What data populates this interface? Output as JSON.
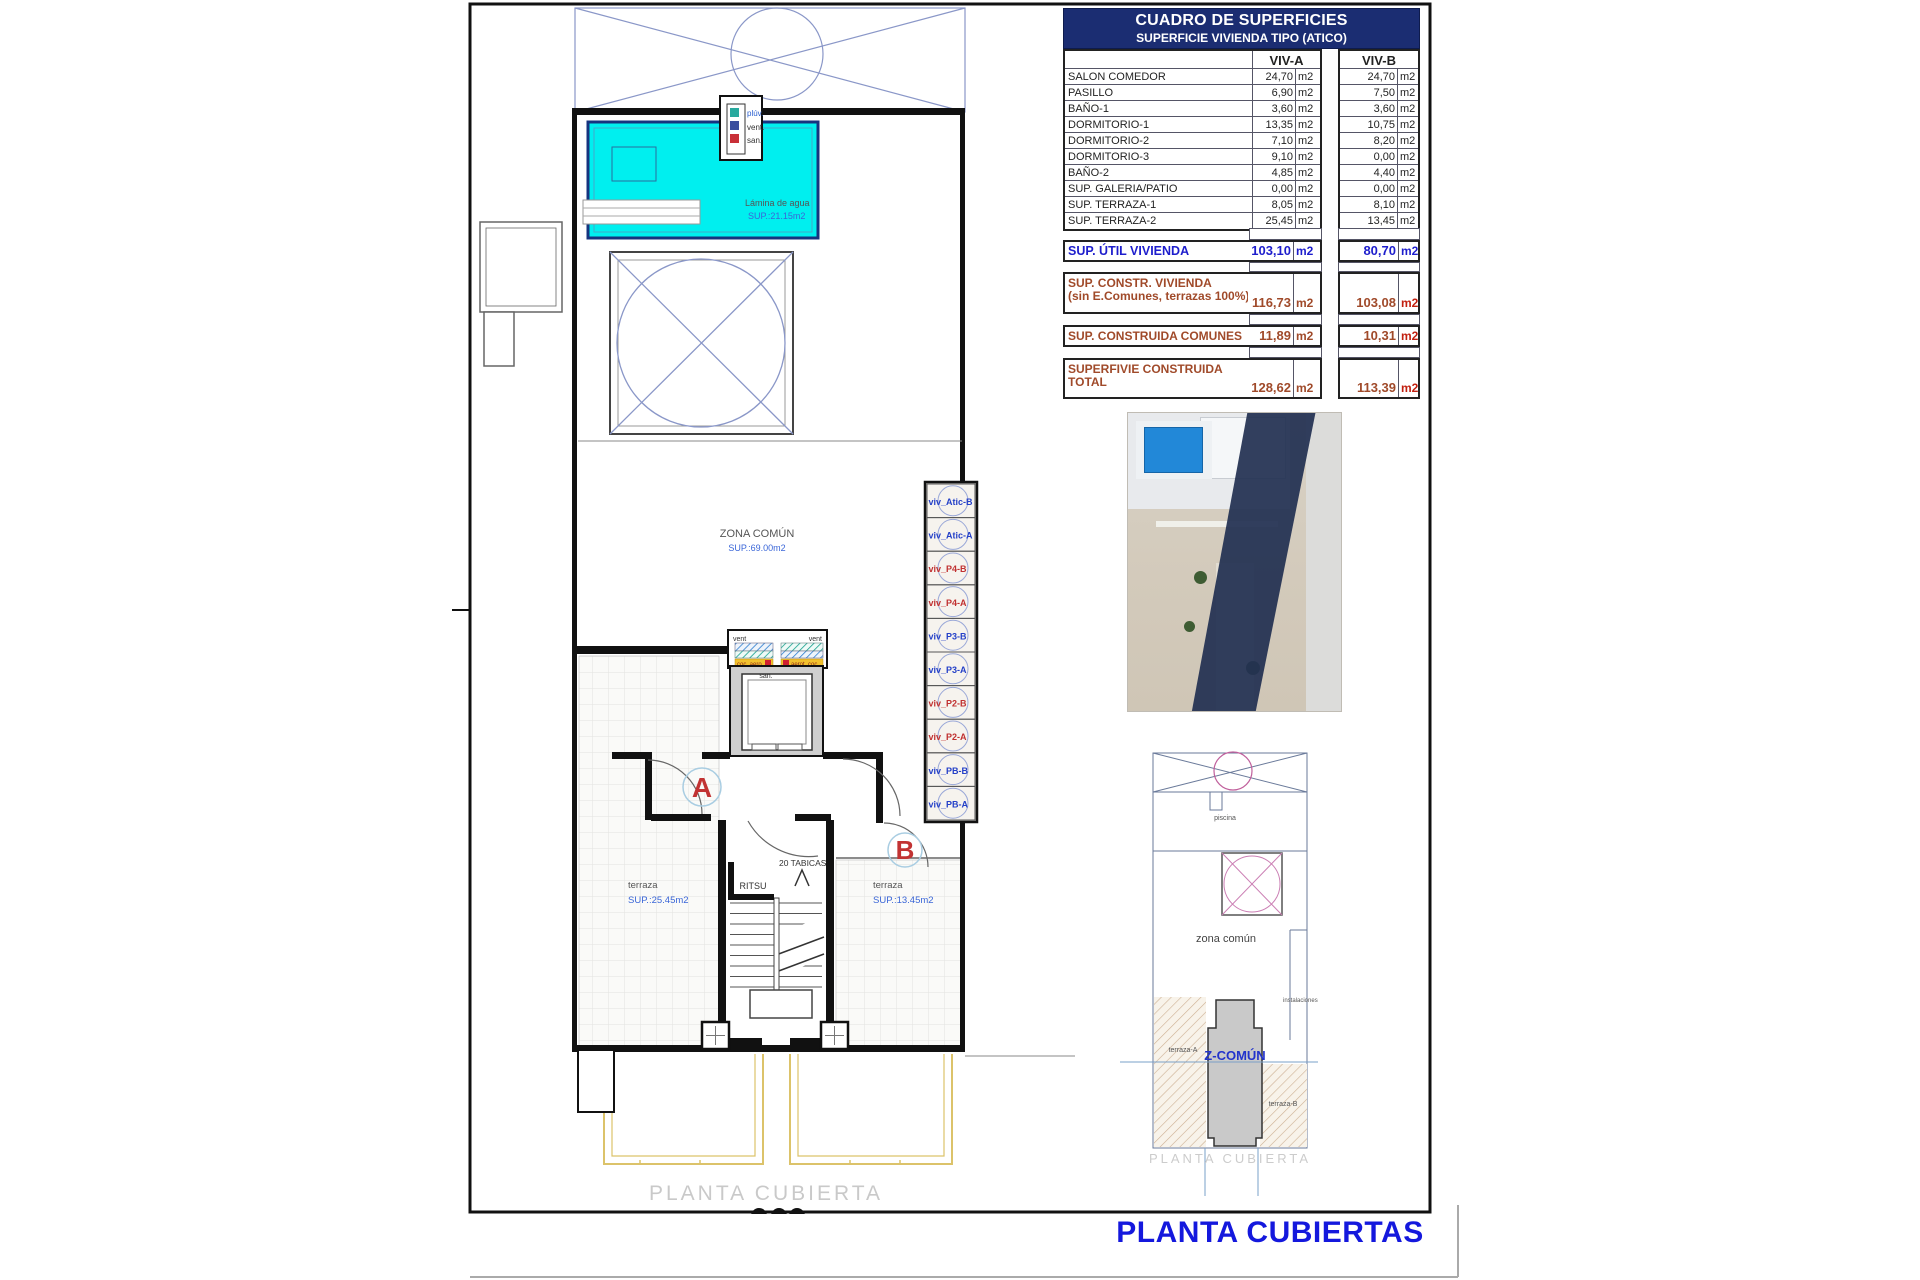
{
  "title_block": {
    "sheet_title": "PLANTA CUBIERTAS"
  },
  "colors": {
    "pool_cyan": "#00efef",
    "table_header_navy": "#1b2d72",
    "total_blue": "#1d1dcc",
    "total_brown": "#a04a2a",
    "unit_red": "#c22010",
    "title_blue": "#1418dd",
    "label_blue": "#2440c8",
    "label_red": "#c03030"
  },
  "table": {
    "title": "CUADRO DE SUPERFICIES",
    "subtitle": "SUPERFICIE VIVIENDA TIPO  (ATICO)",
    "col_a": "VIV-A",
    "col_b": "VIV-B",
    "unit": "m2",
    "rows": [
      {
        "label": "SALON COMEDOR",
        "a": "24,70",
        "b": "24,70"
      },
      {
        "label": "PASILLO",
        "a": "6,90",
        "b": "7,50"
      },
      {
        "label": "BAÑO-1",
        "a": "3,60",
        "b": "3,60"
      },
      {
        "label": "DORMITORIO-1",
        "a": "13,35",
        "b": "10,75"
      },
      {
        "label": "DORMITORIO-2",
        "a": "7,10",
        "b": "8,20"
      },
      {
        "label": "DORMITORIO-3",
        "a": "9,10",
        "b": "0,00"
      },
      {
        "label": "BAÑO-2",
        "a": "4,85",
        "b": "4,40"
      },
      {
        "label": "SUP. GALERIA/PATIO",
        "a": "0,00",
        "b": "0,00"
      },
      {
        "label": "SUP. TERRAZA-1",
        "a": "8,05",
        "b": "8,10"
      },
      {
        "label": "SUP. TERRAZA-2",
        "a": "25,45",
        "b": "13,45"
      }
    ],
    "totals": [
      {
        "label": "SUP. ÚTIL VIVIENDA",
        "label2": "",
        "a": "103,10",
        "b": "80,70"
      },
      {
        "label": "SUP. CONSTR. VIVIENDA",
        "label2": "(sin E.Comunes, terrazas 100%)",
        "a": "116,73",
        "b": "103,08"
      },
      {
        "label": "SUP. CONSTRUIDA COMUNES",
        "label2": "",
        "a": "11,89",
        "b": "10,31"
      },
      {
        "label": "SUPERFIVIE CONSTRUIDA",
        "label2": "TOTAL",
        "a": "128,62",
        "b": "113,39"
      }
    ]
  },
  "plan": {
    "lamina_line1": "Lámina de agua",
    "lamina_line2": "SUP.:21.15m2",
    "zona_line1": "ZONA COMÚN",
    "zona_line2": "SUP.:69.00m2",
    "terraza_a_line1": "terraza",
    "terraza_a_line2": "SUP.:25.45m2",
    "terraza_b_line1": "terraza",
    "terraza_b_line2": "SUP.:13.45m2",
    "label_a": "A",
    "label_b": "B",
    "ritsu": "RITSU",
    "tabicas": "20 TABICAS",
    "caption": "PLANTA CUBIERTA",
    "legend_pool": [
      "plúv.",
      "vent.",
      "san."
    ],
    "vent_left": "vent",
    "vent_right": "vent",
    "coc_aero": "coc. aero",
    "aerot_coc": "aerot. coc.",
    "san": "san.",
    "shaft_labels": [
      {
        "label": "viv_Atic-B",
        "color": "blue"
      },
      {
        "label": "viv_Atic-A",
        "color": "blue"
      },
      {
        "label": "viv_P4-B",
        "color": "red"
      },
      {
        "label": "viv_P4-A",
        "color": "red"
      },
      {
        "label": "viv_P3-B",
        "color": "blue"
      },
      {
        "label": "viv_P3-A",
        "color": "blue"
      },
      {
        "label": "viv_P2-B",
        "color": "red"
      },
      {
        "label": "viv_P2-A",
        "color": "red"
      },
      {
        "label": "viv_PB-B",
        "color": "blue"
      },
      {
        "label": "viv_PB-A",
        "color": "blue"
      }
    ]
  },
  "siteplan": {
    "piscina": "piscina",
    "zona_comun": "zona común",
    "instalaciones": "instalaciones",
    "terraza_a": "terraza-A",
    "terraza_b": "terraza-B",
    "z_comun": "Z-COMÚN",
    "caption": "PLANTA CUBIERTA"
  }
}
